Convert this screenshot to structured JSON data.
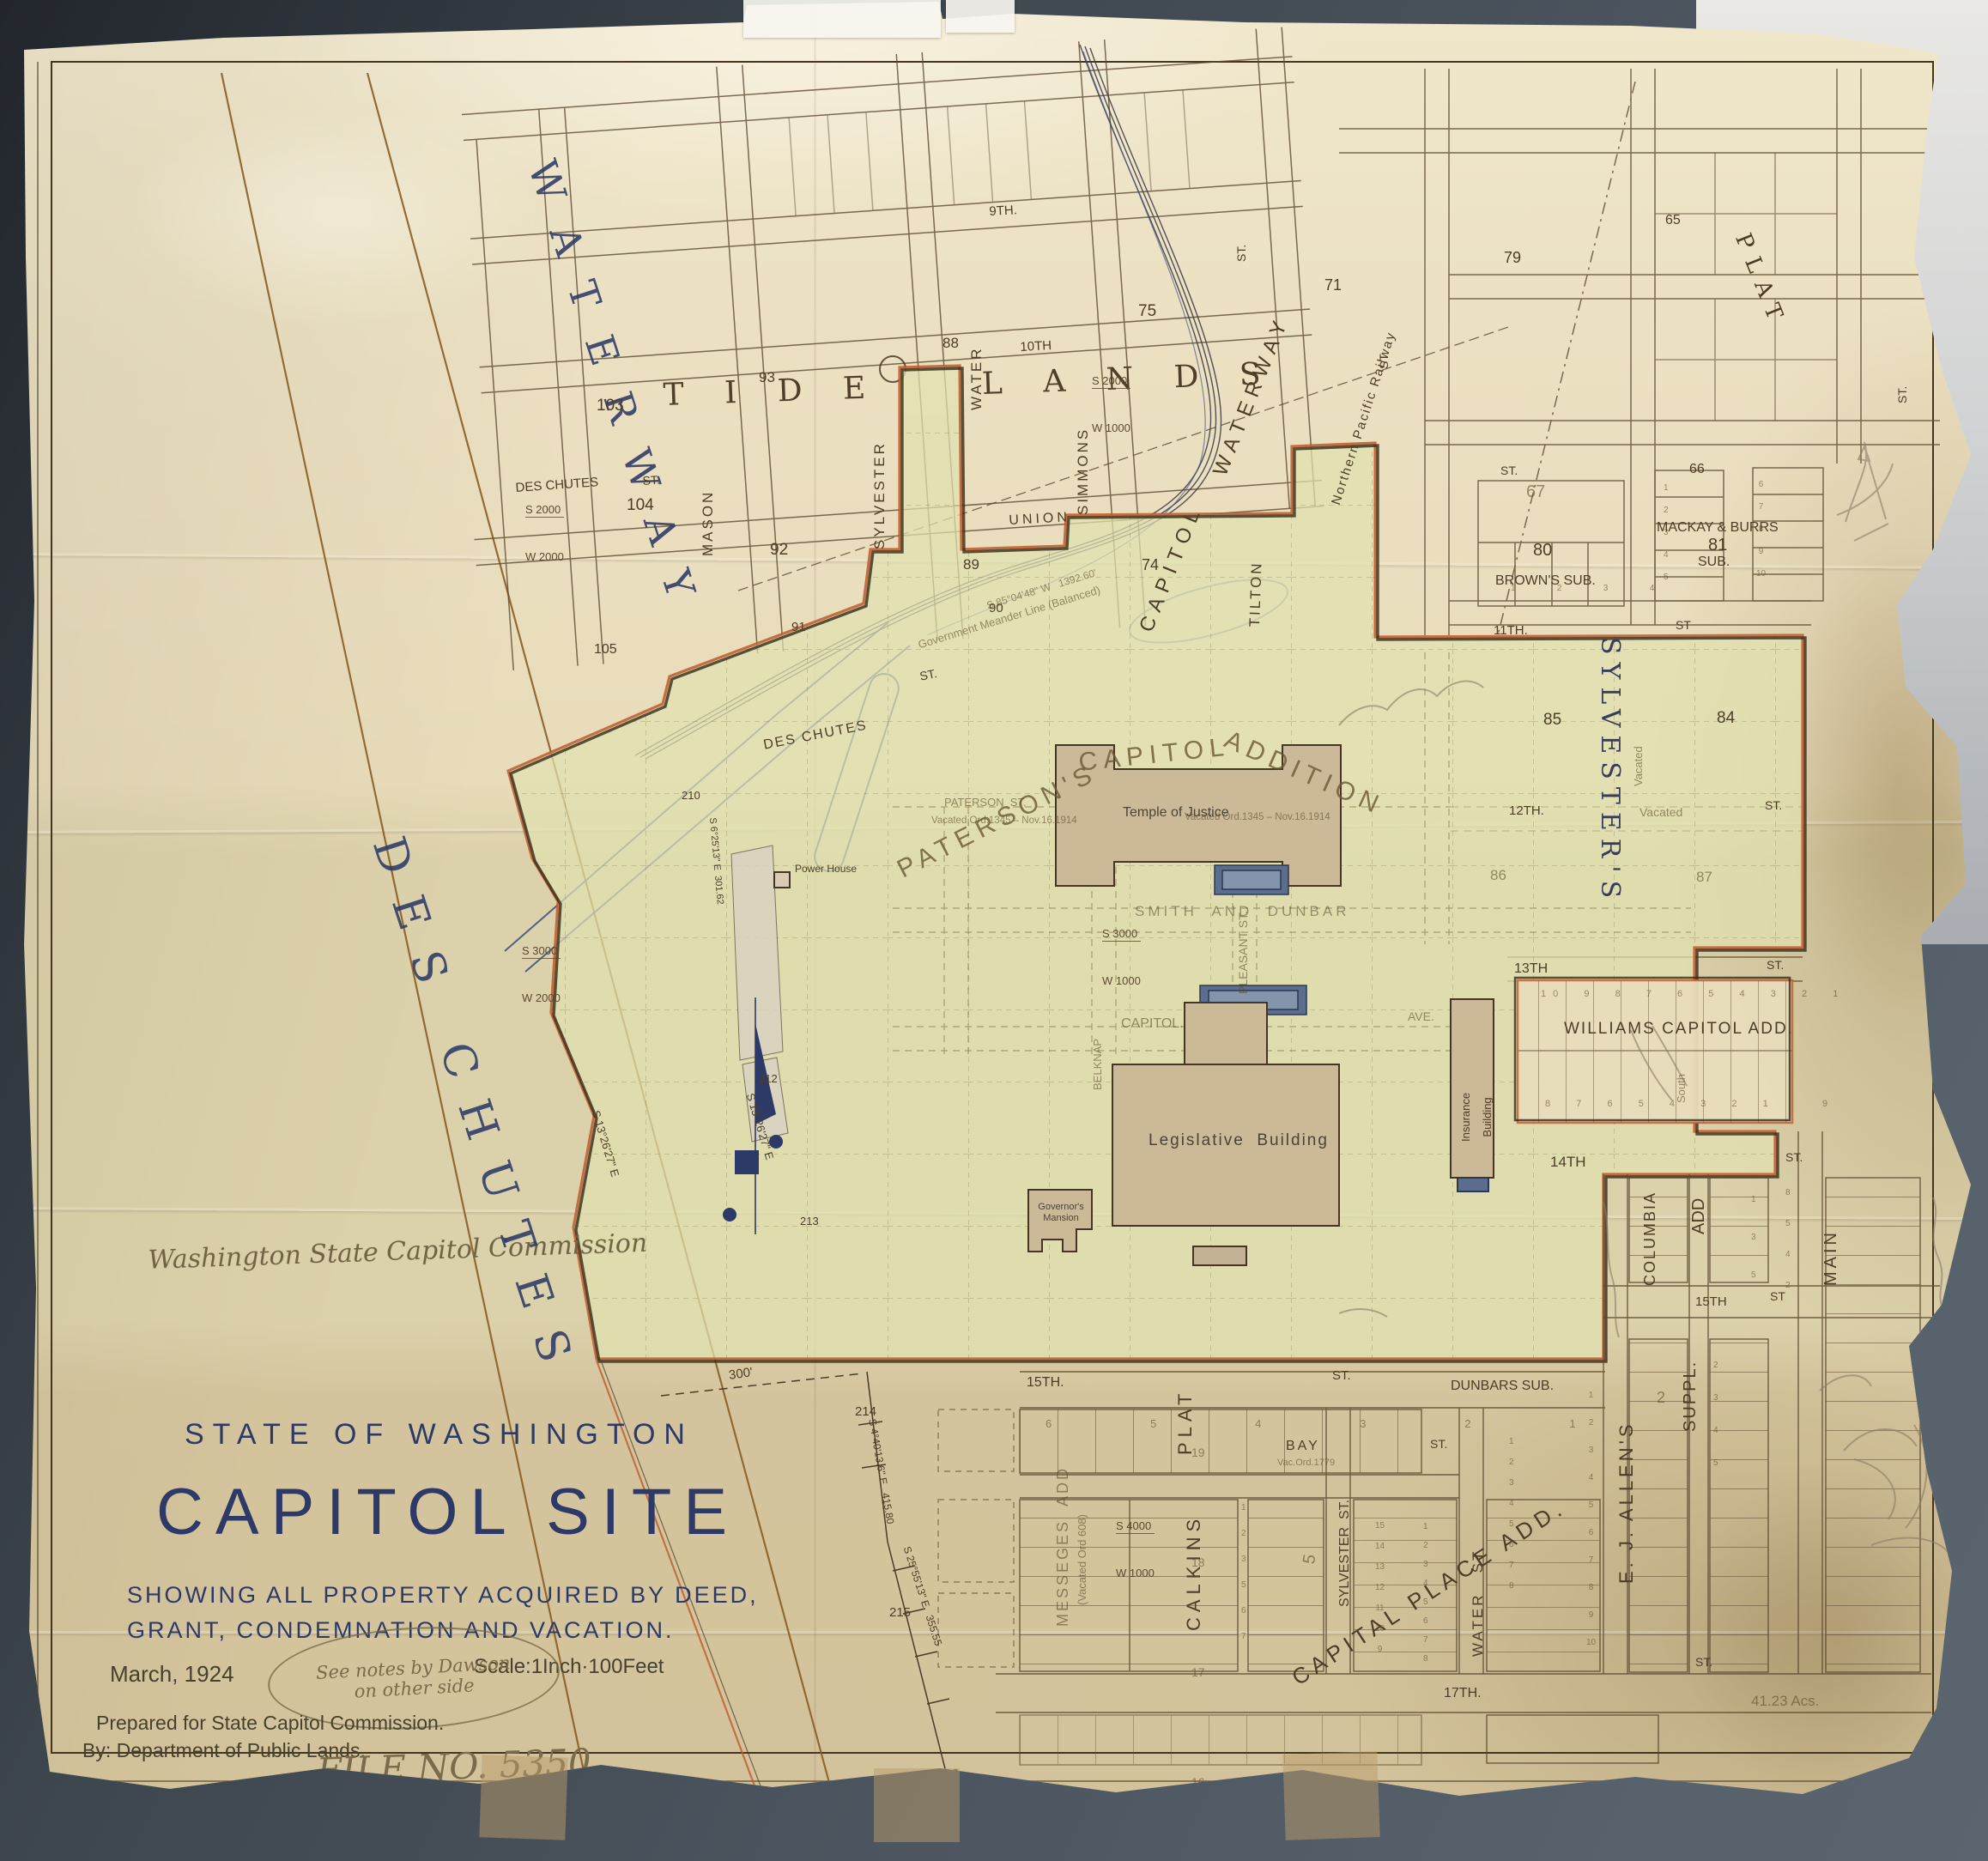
{
  "t": {
    "state": "STATE OF WASHINGTON",
    "title": "CAPITOL SITE",
    "sub1": "SHOWING ALL PROPERTY ACQUIRED BY DEED,",
    "sub2": "GRANT, CONDEMNATION AND VACATION.",
    "date": "March, 1924",
    "scale": "Scale:1Inch·100Feet",
    "note1": "See notes by Dawson",
    "note2": "on other side",
    "prep1": "Prepared for State Capitol Commission.",
    "prep2": "By: Department of Public Lands.",
    "file": "FILE NO. 5350",
    "plan": "PLAN NO. 31",
    "sig": "Washington State Capitol Commission"
  },
  "r": {
    "tide": "T I D E    L A N D S",
    "waterway": "WATERWAY",
    "deschutes": "DES CHUTES",
    "cap1": "CAPITOL",
    "cap2": "WATERWAY",
    "rail": "Northern Pacific Railway",
    "meander": "Government Meander Line (Balanced)",
    "pat1": "PATERSON'S",
    "pat2": "CAPITOL",
    "pat3": "ADDITION",
    "sylvesters": "SYLVESTER'S",
    "plat": "PLAT",
    "williams": "WILLIAMS CAPITOL ADD.",
    "browns": "BROWN'S SUB.",
    "mackay": "MACKAY & BURRS",
    "sub": "SUB.",
    "calkins": "CALKINS",
    "calkplat": "PLAT",
    "messeges": "MESSEGES  ADD",
    "messvac": "(Vacated Ord 608)",
    "dunbars": "DUNBARS SUB.",
    "capplace": "CAPITAL PLACE ADD.",
    "ejallens": "E. J. ALLEN'S",
    "columbia": "COLUMBIA",
    "add": "ADD",
    "suppl": "SUPPL.",
    "main": "MAIN",
    "smith": "SMITH  AND  DUNBAR",
    "acres": "41.23 Acs."
  },
  "s": {
    "mason": "MASON",
    "sylv": "SYLVESTER",
    "simmons": "SIMMONS",
    "tilton": "TILTON",
    "water": "WATER",
    "union": "UNION",
    "n9": "9TH.",
    "n10": "10TH",
    "n11": "11TH.",
    "n12": "12TH.",
    "n13": "13TH",
    "n14": "14TH",
    "n15": "15TH.",
    "n15e": "15TH",
    "n17": "17TH.",
    "st": "ST.",
    "stp": "ST",
    "vac": "Vacated",
    "dc": "DES CHUTES",
    "capitol": "CAPITOL.",
    "pleasant": "PLEASANT ST.",
    "belknap": "BELKNAP",
    "bay": "BAY",
    "ave": "AVE.",
    "watst": "WATER   ST",
    "sylvst": "SYLVESTER  ST.",
    "south": "South",
    "patst": "PATERSON  ST.",
    "vac1345": "Vacated Ord.1345 – Nov.16.1914",
    "vac1779": "Vac.Ord.1779"
  },
  "b": {
    "temple": "Temple of Justice",
    "leg": "Legislative  Building",
    "gov": "Governor's\nMansion",
    "power": "Power House",
    "ins": "Insurance\nBuilding"
  },
  "n": {
    "b103": "103",
    "b93": "93",
    "b88": "88",
    "b104": "104",
    "b92": "92",
    "b89": "89",
    "b90": "90",
    "b91": "91",
    "b105": "105",
    "b75": "75",
    "b71": "71",
    "b74": "74",
    "b79": "79",
    "b65": "65",
    "b66": "66",
    "b67": "67",
    "b80": "80",
    "b81": "81",
    "b85": "85",
    "b84": "84",
    "b86": "86",
    "b87": "87",
    "b2": "2",
    "b5": "5",
    "n210": "210",
    "n212": "212",
    "n213": "213",
    "n214": "214",
    "n215": "215",
    "n216": "216",
    "calcol": "19\n18\n17\n16"
  },
  "l": {
    "wtop": "10  9  8  7  6  5  4  3  2  1",
    "wbot": "8  7  6  5  4  3  2  1     9",
    "browns": "1   2   3   4",
    "mack1": "1\n2\n3\n4\n5",
    "mack2": "6\n7\n8\n9\n10",
    "dunrow": "6   5   4   3   2   1",
    "cpl": "15\n14\n13\n12\n11\n10\n9",
    "cpr": "1\n2\n3\n4\n5\n6\n7\n8",
    "watercol": "1\n2\n3\n4\n5\n6\n7\n8",
    "baycol": "1\n2\n3\n5\n6\n7",
    "colcol": "1\n3\n5",
    "maincol": "8\n5\n4\n2",
    "ejcol": "1\n2\n3\n4\n5\n6\n7\n8\n9\n10",
    "suppcol": "2\n3\n4\n5"
  },
  "v": {
    "s3000": "S 3000",
    "s2000": "S 2000",
    "s4000": "S 4000",
    "w2000": "W 2000",
    "w1000": "W 1000",
    "bchutes": "S 13°26'27\" E",
    "b214": "S 4°40'13.6\" E   415.80",
    "b215": "S 25°55'13\" E   355.55",
    "b301": "S 6°25'13\" E  301.62",
    "bmeander": "S 85°04'48\" W   1392.60'",
    "d300": "300'"
  }
}
